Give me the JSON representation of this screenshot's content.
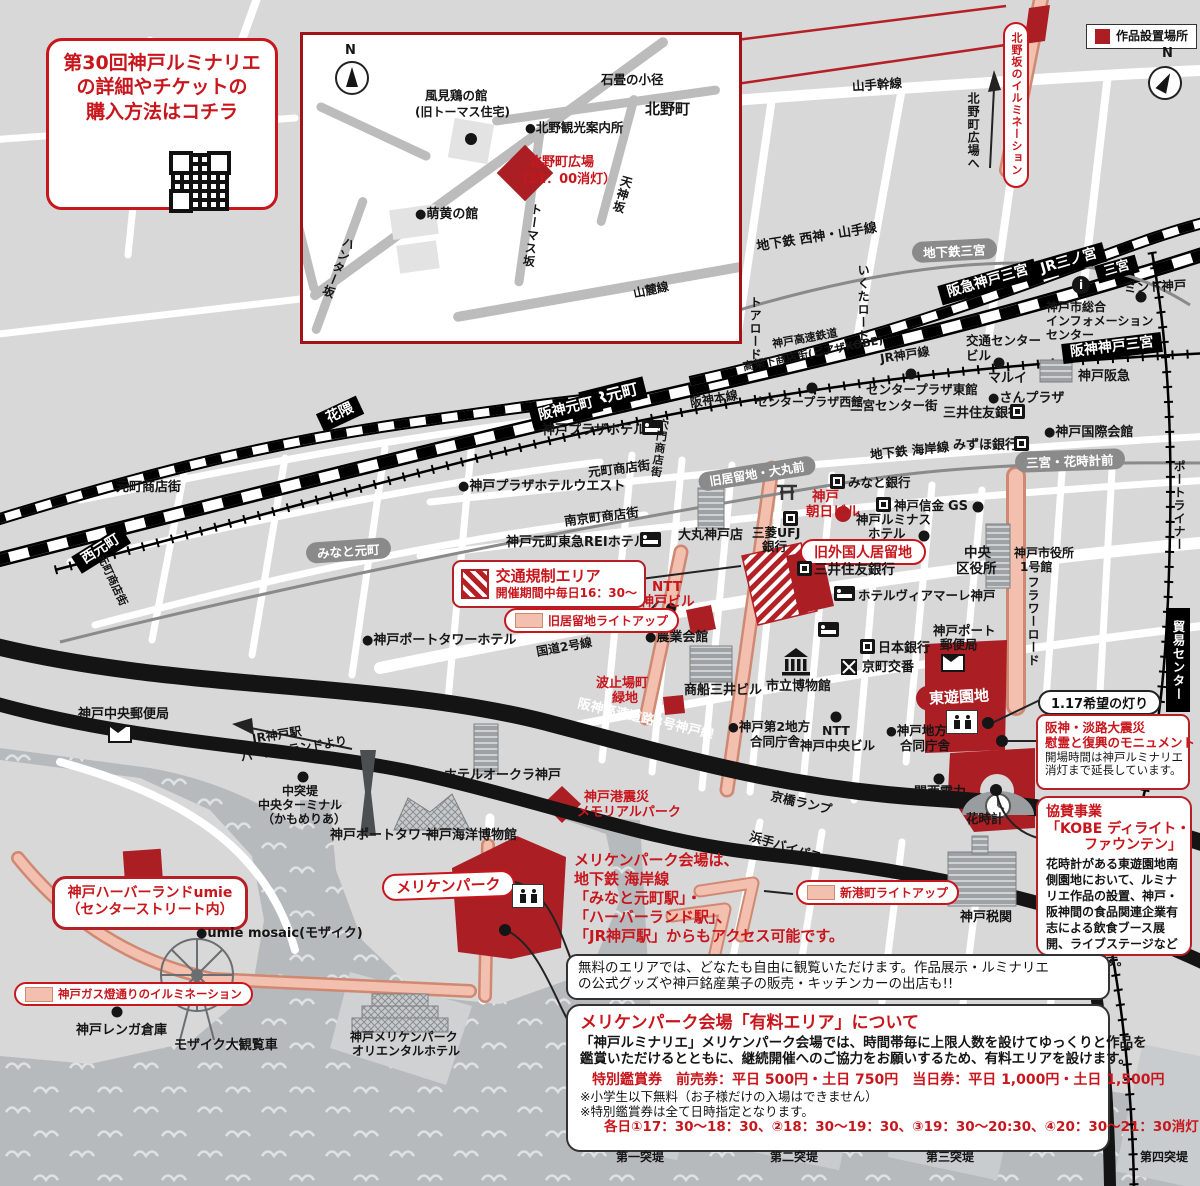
{
  "colors": {
    "red_text": "#c8161d",
    "red_fill": "#ab1f24",
    "salmon": "#f3bfae",
    "water": "#b7babd"
  },
  "ticket_box": {
    "line1": "第30回神戸ルミナリエ",
    "line2": "の詳細やチケットの",
    "line3": "購入方法はコチラ"
  },
  "legend": {
    "artwork": "作品設置場所"
  },
  "compass": {
    "n": "N"
  },
  "inset": {
    "kazami1": "風見鶏の館",
    "kazami2": "(旧トーマス住宅)",
    "annai": "●北野観光案内所",
    "ishidatami": "石畳の小径",
    "kitano": "北野町",
    "hiroba1": "北野町広場",
    "hiroba2": "（21：00消灯）",
    "moegi": "●萌黄の館",
    "hunter": "ハンター坂",
    "thomas": "トーマス坂",
    "tenjin": "天神坂",
    "sanroku": "山麓線"
  },
  "t": {
    "kitanozaka": "北野坂のイルミネーション",
    "to_kitano": "北野町広場へ",
    "yamate": "山手幹線",
    "seishin_yamate": "地下鉄 西神・山手線",
    "st_chika_san": "地下鉄三宮",
    "ikuta": "いくたロード",
    "toa": "トアロード",
    "kobe_kosoku": "神戸高速鉄道",
    "koukashita": "高架下商店街(ピアザKOBE)",
    "jr_kobe_line": "JR神戸線",
    "hanshin_honsen": "阪神本線",
    "st_hankyu_san": "阪急神戸三宮",
    "st_jr_san": "JR三ノ宮",
    "st_sannomiya": "三宮",
    "info_i": "i",
    "st_hanshin_san": "阪神神戸三宮",
    "mint": "ミント神戸",
    "info1": "神戸市総合",
    "info2": "インフォメーション",
    "info3": "センター",
    "kotsu1": "交通センター",
    "kotsu2": "ビル",
    "cp_east": "センタープラザ東館",
    "cp_west": "センタープラザ西館",
    "sancenter": "三宮センター街",
    "marui": "マルイ",
    "sanplaza": "●さんプラザ",
    "kobe_hankyu": "神戸阪急",
    "smbc1": "三井住友銀行",
    "kokusai": "●神戸国際会館",
    "mizuho": "みずほ銀行",
    "kaigan_line": "地下鉄 海岸線",
    "st_hanadokei": "三宮・花時計前",
    "port_liner": "ポートライナー",
    "boeki": "貿易センター",
    "flower_road": "フラワーロード",
    "st_hanakuma": "花隈",
    "st_nishimoto": "西元町",
    "motomachi1": "元町商店街",
    "motomachi2": "元町商店街",
    "motomachi3": "元町商店街",
    "st_minatomoto": "みなと元町",
    "st_jr_moto": "JR元町",
    "st_hanshin_moto": "阪神元町",
    "kobe_plaza": "神戸プラザホテル",
    "anamon": "穴門商店街",
    "plaza_west": "●神戸プラザホテルウエスト",
    "nankinmachi": "南京町商店街",
    "tokyu_rei": "神戸元町東急REIホテル",
    "daimaru": "大丸神戸店",
    "mufg1": "三菱UFJ",
    "mufg2": "銀行",
    "asahi1": "神戸",
    "asahi2": "朝日ビル",
    "kyoryuchi_daimaru": "旧居留地・大丸前",
    "minato_bank": "みなと銀行",
    "shinkin": "神戸信金",
    "gs": "GS",
    "luminous1": "神戸ルミナス",
    "luminous2": "ホテル",
    "kyu_gaikokujin": "旧外国人居留地",
    "smbc2": "三井住友銀行",
    "viamare": "ホテルヴィアマーレ神戸",
    "chuo_ku1": "中央",
    "chuo_ku2": "区役所",
    "shiyakusho1": "神戸市役所",
    "shiyakusho2": "1号館",
    "port_post1": "神戸ポート",
    "port_post2": "郵便局",
    "boj": "日本銀行",
    "koban": "京町交番",
    "museum": "市立博物館",
    "mol": "商船三井ビル",
    "nogyo": "●農業会館",
    "ntt_shin1": "NTT",
    "ntt_shin2": "新神戸ビル",
    "kokudo2": "国道2号線",
    "hatoba1": "波止場町",
    "hatoba2": "緑地",
    "tower_hotel": "●神戸ポートタワーホテル",
    "hanshin_kosoku": "阪神高速道路3号神戸線",
    "chuo_post": "神戸中央郵便局",
    "jrkobe1": "JR神戸駅",
    "jrkobe2": "ハーバーランドより",
    "okura": "ホテルオークラ神戸",
    "port_tower": "神戸ポートタワー",
    "kaiyo": "神戸海洋博物館",
    "naka1": "中突堤",
    "naka2": "中央ターミナル",
    "naka3": "（かもめりあ）",
    "meriken": "メリケンパーク",
    "memorial1": "神戸港震災",
    "memorial2": "メモリアルパーク",
    "godo2_1": "●神戸第2地方",
    "godo2_2": "合同庁舎",
    "ntt2": "NTT",
    "ntt2b": "神戸中央ビル",
    "godo1": "●神戸地方",
    "godo1b": "合同庁舎",
    "kanden": "関西電力",
    "hanadokei": "花時計",
    "kyobashi": "京橋ランプ",
    "hamate": "浜手バイパス",
    "zeikan": "神戸税関",
    "higashi": "東遊園地",
    "hope": "1.17希望の灯り",
    "umie_mosaic": "●umie mosaic(モザイク)",
    "renga": "神戸レンガ倉庫",
    "mosaic_wheel": "モザイク大観覧車",
    "meriken_ori1": "神戸メリケンパーク",
    "meriken_ori2": "オリエンタルホテル",
    "tottei1": "第一突堤",
    "tottei2": "第二突堤",
    "tottei3": "第三突堤",
    "tottei4": "第四突堤"
  },
  "boxes": {
    "regulation": {
      "line1": "交通規制エリア",
      "line2": "開催期間中毎日16：30〜"
    },
    "kyoryuchi_lightup": "旧居留地ライトアップ",
    "shinminato_lightup": "新港町ライトアップ",
    "gas_lightup": "神戸ガス燈通りのイルミネーション",
    "monument": {
      "t1": "阪神・淡路大震災",
      "t2": "慰霊と復興のモニュメント",
      "b1": "開場時間は神戸ルミナリエ",
      "b2": "消灯まで延長しています。"
    },
    "sponsor": {
      "t1": "協賛事業",
      "t2": "「KOBE ディライト・",
      "t3": "ファウンテン」",
      "body": "花時計がある東遊園地南側園地において、ルミナリエ作品の設置、神戸・阪神間の食品関連企業有志による飲食ブース展開、ライブステージなどを実施します。"
    },
    "access": {
      "l1": "メリケンパーク会場は、",
      "l2": "地下鉄 海岸線",
      "l3": "「みなと元町駅」・",
      "l4": "「ハーバーランド駅」、",
      "l5": "「JR神戸駅」からもアクセス可能です。"
    },
    "free": {
      "l1": "無料のエリアでは、どなたも自由に観覧いただけます。作品展示・ルミナリエ",
      "l2": "の公式グッズや神戸銘産菓子の販売・キッチンカーの出店も!!"
    },
    "paid": {
      "title": "メリケンパーク会場「有料エリア」について",
      "body1": "「神戸ルミナリエ」メリケンパーク会場では、時間帯毎に上限人数を設けてゆっくりと作品を",
      "body2": "鑑賞いただけるとともに、継続開催へのご協力をお願いするため、有料エリアを設けます。",
      "price": "特別鑑賞券　前売券：平日 500円・土日 750円　当日券：平日 1,000円・土日 1,500円",
      "note1": "※小学生以下無料（お子様だけの入場はできません）",
      "note2": "※特別鑑賞券は全て日時指定となります。",
      "times": "各日①17：30～18：30、②18：30～19：30、③19：30～20:30、④20：30～21：30消灯"
    },
    "umie": {
      "l1": "神戸ハーバーランドumie",
      "l2": "（センターストリート内）"
    }
  }
}
